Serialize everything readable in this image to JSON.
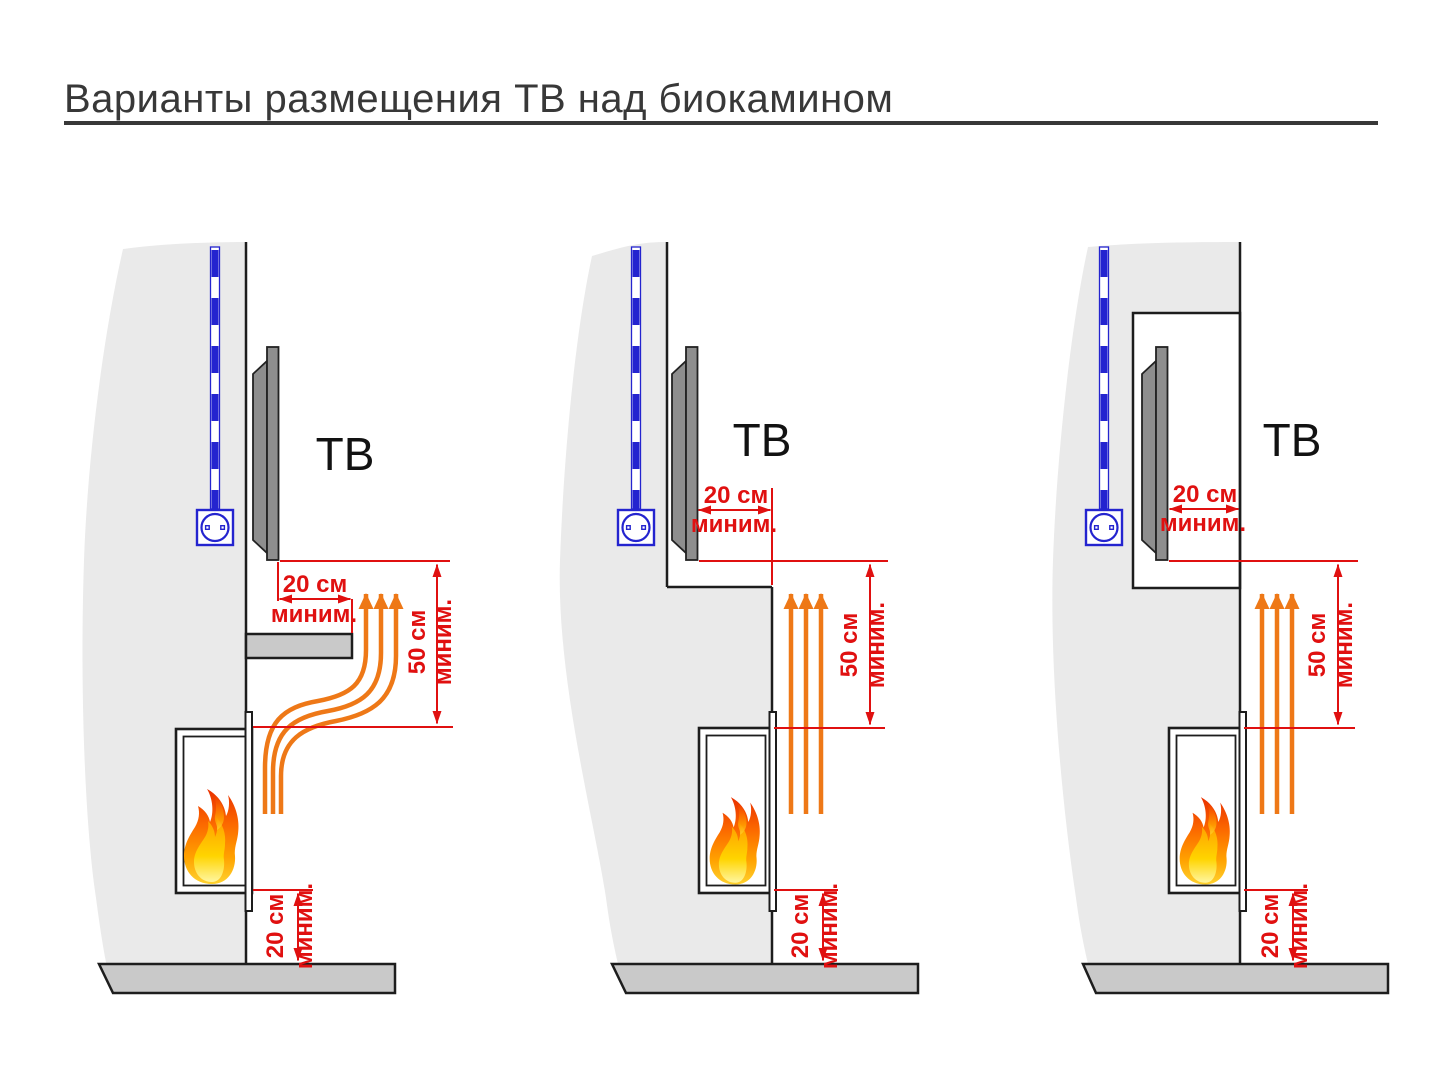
{
  "page": {
    "title": "Варианты размещения ТВ над биокамином"
  },
  "colors": {
    "dimension_red": "#e01010",
    "heat_arrow_orange": "#ee7817",
    "cable_blue": "#2424cf",
    "wall_gray": "#eaeaea",
    "floor_gray": "#c9c9c9",
    "tv_gray": "#8e8e8e",
    "outline_black": "#1d1d1d",
    "title_color": "#383838",
    "flame_top": "#e93000",
    "flame_mid": "#ff7c00",
    "flame_bottom": "#ffd22e"
  },
  "diagrams": [
    {
      "id": "variant-1-protective-shelf",
      "tv_label": "ТВ",
      "side_clearance": {
        "value": "20 см",
        "qualifier": "миним."
      },
      "vertical_clearance": {
        "value": "50 см",
        "qualifier": "миним."
      },
      "floor_clearance": {
        "value": "20 см",
        "qualifier": "миним."
      }
    },
    {
      "id": "variant-2-stepped-wall",
      "tv_label": "ТВ",
      "side_clearance": {
        "value": "20 см",
        "qualifier": "миним."
      },
      "vertical_clearance": {
        "value": "50 см",
        "qualifier": "миним."
      },
      "floor_clearance": {
        "value": "20 см",
        "qualifier": "миним."
      }
    },
    {
      "id": "variant-3-tv-niche",
      "tv_label": "ТВ",
      "side_clearance": {
        "value": "20 см",
        "qualifier": "миним."
      },
      "vertical_clearance": {
        "value": "50 см",
        "qualifier": "миним."
      },
      "floor_clearance": {
        "value": "20 см",
        "qualifier": "миним."
      }
    }
  ]
}
